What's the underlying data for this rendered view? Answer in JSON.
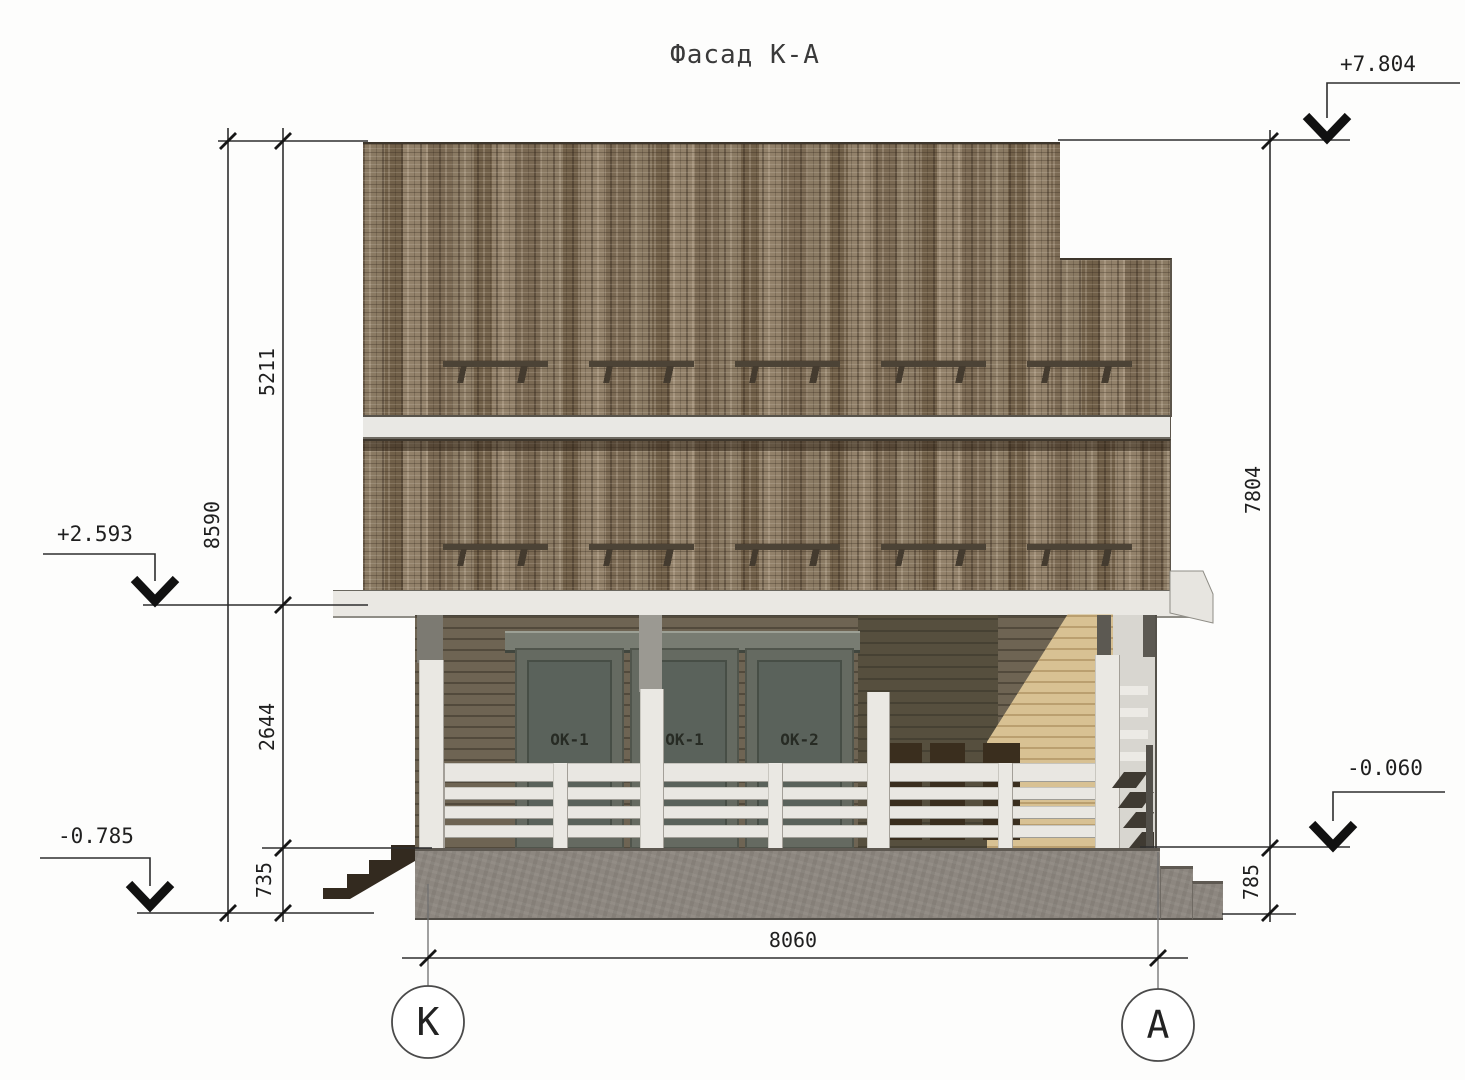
{
  "title": "Фасад К-А",
  "elevations": {
    "roof_top": "+7.804",
    "second_floor": "+2.593",
    "ground_left": "-0.785",
    "terrace": "-0.060"
  },
  "dimensions": {
    "left_upper": "5211",
    "left_total": "8590",
    "left_middle": "2644",
    "left_lower": "735",
    "right_total": "7804",
    "right_lower": "785",
    "bottom_width": "8060"
  },
  "windows": [
    "ОК-1",
    "ОК-1",
    "ОК-2"
  ],
  "axes": {
    "left": "К",
    "right": "А"
  },
  "colors": {
    "shingle_brown": "#84735c",
    "siding_brown_grey": "#6e6453",
    "gable_tan": "#d8c193",
    "trim_white": "#eae8e3",
    "concrete_grey": "#8d8780",
    "line": "#2e2e2e"
  }
}
